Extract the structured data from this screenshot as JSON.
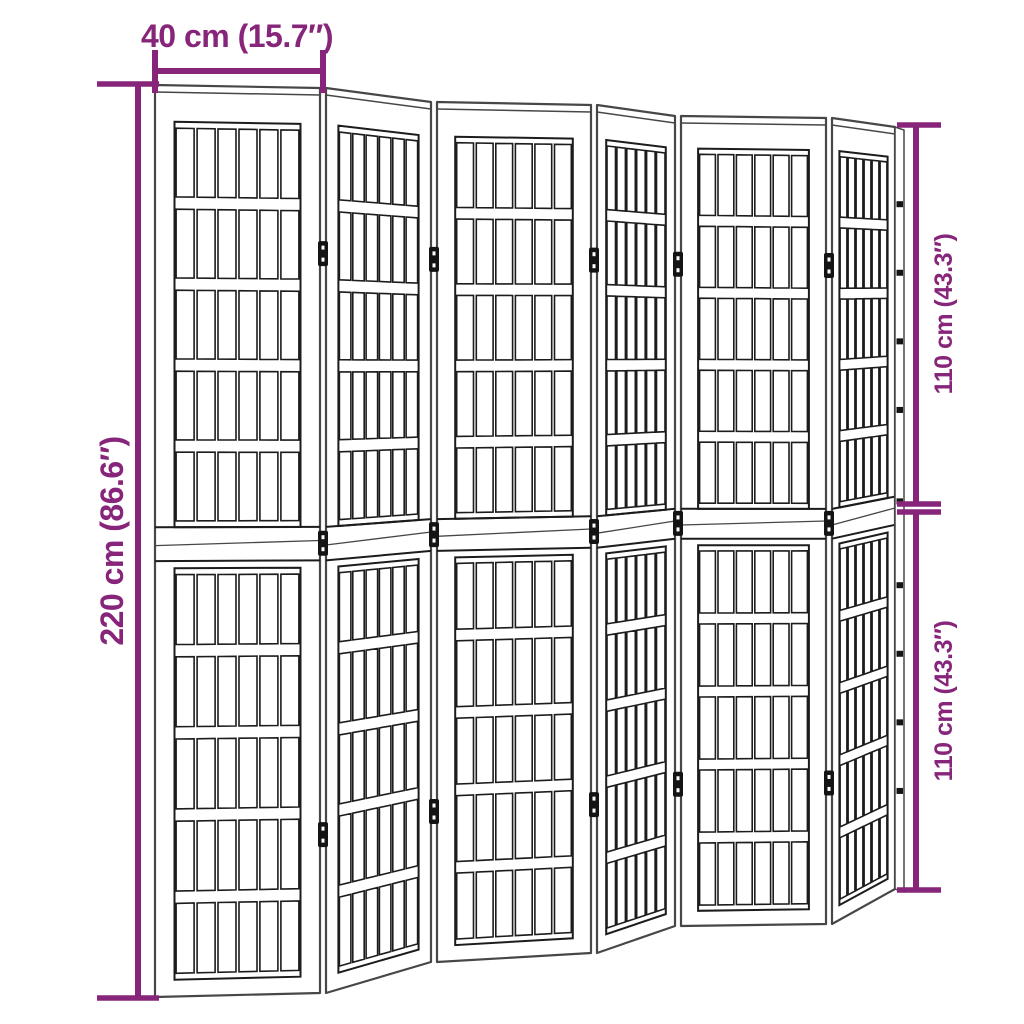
{
  "product": {
    "name": "folding-room-divider-dimension-diagram",
    "panel_count_visible": 6
  },
  "dimensions": {
    "panel_width": {
      "label": "40 cm (15.7″)"
    },
    "total_height": {
      "label": "220 cm (86.6″)"
    },
    "half_height_top": {
      "label": "110 cm (43.3″)"
    },
    "half_height_bottom": {
      "label": "110 cm (43.3″)"
    }
  },
  "colors": {
    "dimension_accent": "#862579",
    "frame_line": "#474747",
    "lattice_line": "#1c1c1c",
    "hinge": "#141414",
    "background": "#ffffff"
  },
  "structure": {
    "panels": 6,
    "halves_per_panel": 2,
    "columns_per_half": 6,
    "rows_per_half": 5,
    "folds_with_hinges": 5,
    "hinges_per_fold": 3
  }
}
